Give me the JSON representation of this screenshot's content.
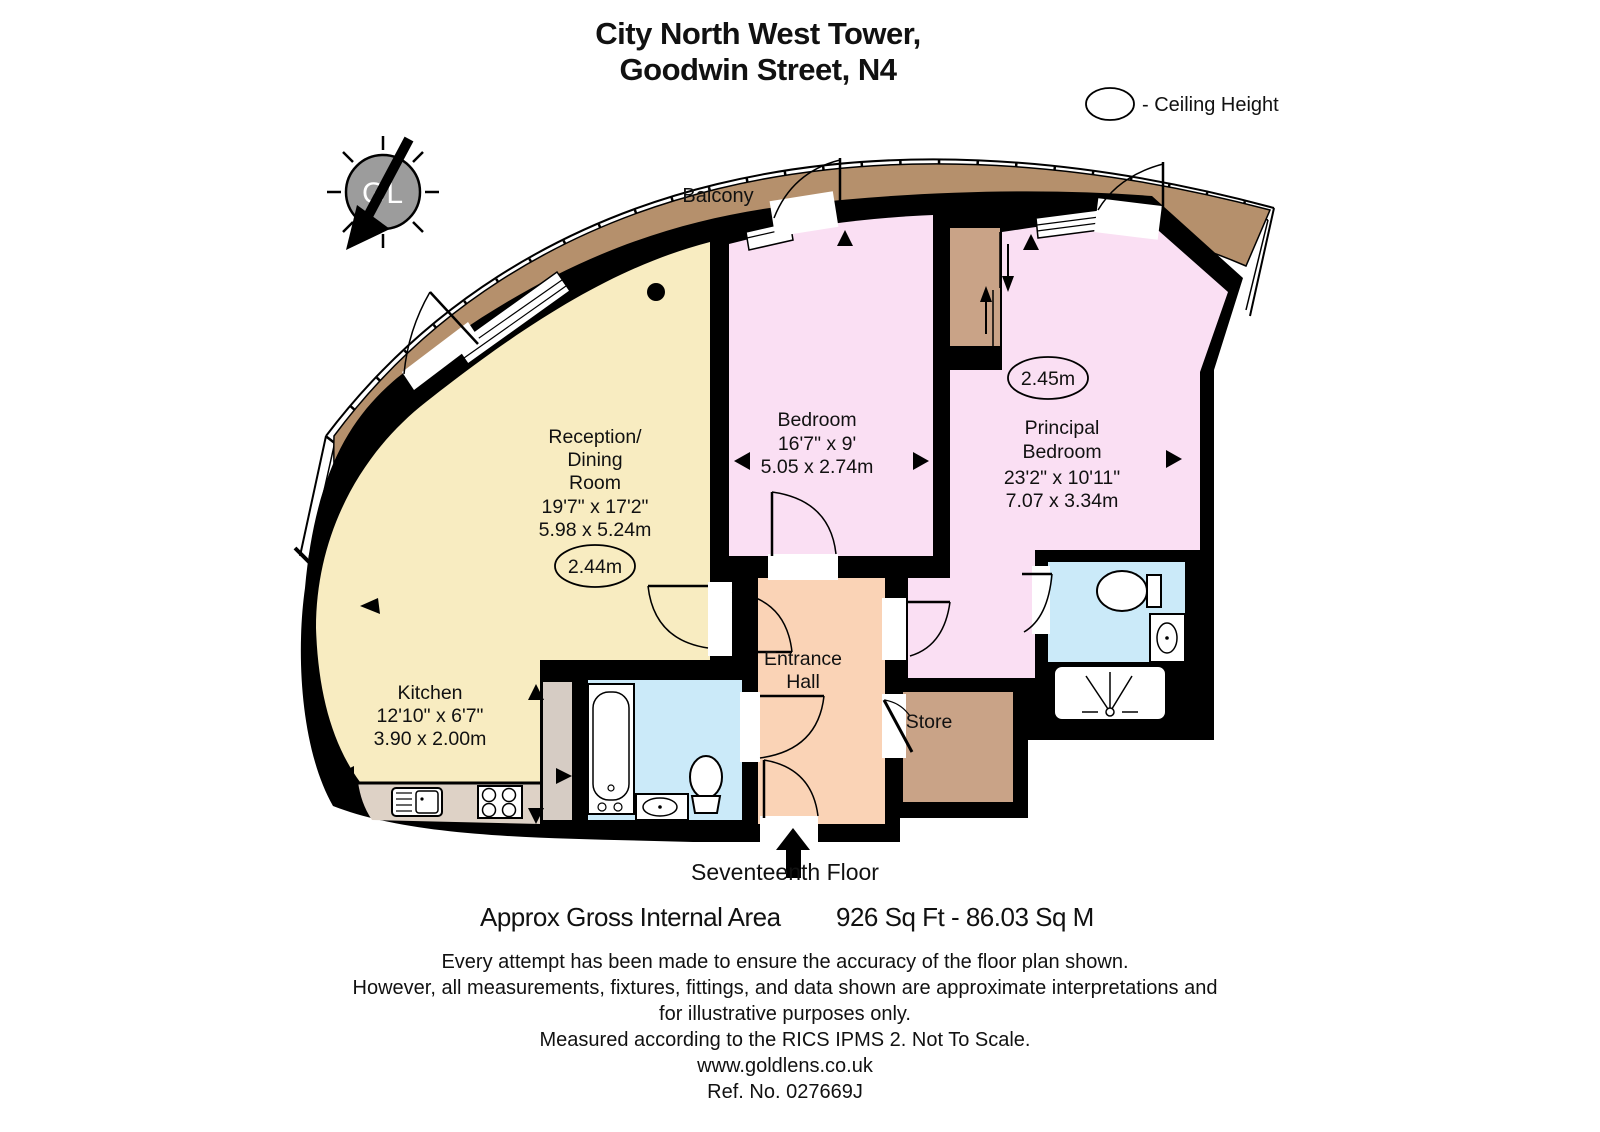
{
  "title": {
    "line1": "City North West Tower,",
    "line2": "Goodwin Street, N4"
  },
  "legend": {
    "ceiling_height": "- Ceiling Height"
  },
  "compass": {
    "initials": "GL"
  },
  "plan": {
    "balcony_label": "Balcony",
    "reception": {
      "line1": "Reception/",
      "line2": "Dining",
      "line3": "Room",
      "imperial": "19'7\" x 17'2\"",
      "metric": "5.98 x 5.24m",
      "ceiling": "2.44m"
    },
    "bedroom": {
      "name": "Bedroom",
      "imperial": "16'7\" x 9'",
      "metric": "5.05 x 2.74m"
    },
    "principal_bedroom": {
      "line1": "Principal",
      "line2": "Bedroom",
      "imperial": "23'2\" x 10'11\"",
      "metric": "7.07 x 3.34m",
      "ceiling": "2.45m"
    },
    "kitchen": {
      "name": "Kitchen",
      "imperial": "12'10\" x 6'7\"",
      "metric": "3.90 x 2.00m"
    },
    "entrance_hall": {
      "line1": "Entrance",
      "line2": "Hall"
    },
    "store": {
      "name": "Store"
    }
  },
  "footer": {
    "floor": "Seventeenth Floor",
    "area_label": "Approx Gross Internal Area",
    "area_value": "926 Sq Ft  - 86.03 Sq M",
    "disclaimer": [
      "Every attempt has been made to ensure the accuracy of the floor plan shown.",
      "However, all measurements, fixtures, fittings, and data shown are approximate interpretations and",
      "for illustrative purposes only.",
      "Measured according to the RICS IPMS 2. Not To Scale."
    ],
    "website": "www.goldlens.co.uk",
    "reference": "Ref. No. 027669J"
  },
  "colors": {
    "balcony": "#b5906c",
    "reception": "#f8ecc1",
    "bedroom": "#fadff3",
    "principal": "#fadff3",
    "hall": "#fad3b6",
    "store": "#c9a387",
    "bathroom": "#cbeaf9",
    "ensuite": "#cbeaf9",
    "counter": "#ded2c6",
    "cupboard": "#d6ccc4",
    "wardrobe": "#c9a387",
    "wall": "#000000"
  }
}
